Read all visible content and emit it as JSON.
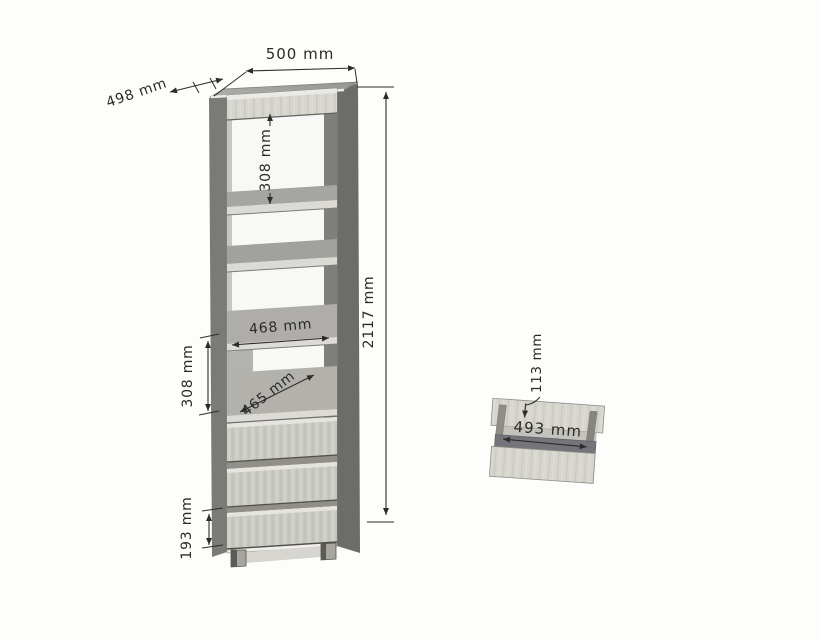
{
  "diagram": {
    "cabinet": {
      "width": "500 mm",
      "depth": "498 mm",
      "height": "2117 mm",
      "shelf_spacing_top": "308 mm",
      "shelf_inner_width": "468 mm",
      "shelf_inner_depth": "465 mm",
      "shelf_spacing_lower": "308 mm",
      "bottom_drawer_height": "193 mm"
    },
    "drawer_detail": {
      "inner_height": "113 mm",
      "inner_width": "493 mm"
    }
  }
}
